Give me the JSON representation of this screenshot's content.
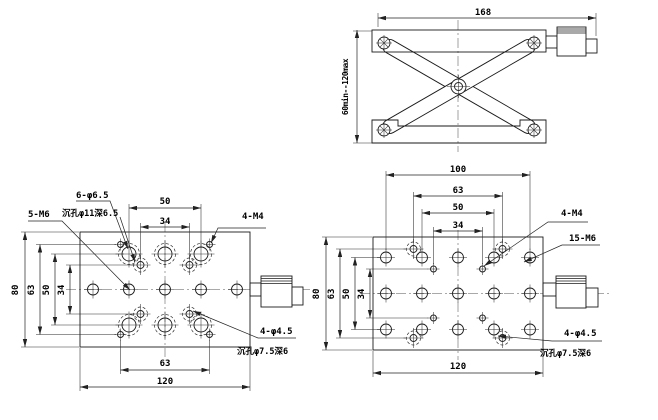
{
  "side_view": {
    "width": "168",
    "travel": "60min--120max"
  },
  "left_view": {
    "dim_top_50": "50",
    "dim_top_34": "34",
    "dim_left_80": "80",
    "dim_left_63": "63",
    "dim_left_50": "50",
    "dim_left_34": "34",
    "dim_bottom_63": "63",
    "dim_bottom_120": "120",
    "label_counterbore_qty": "6-φ6.5",
    "label_counterbore_spec": "沉孔φ11深6.5",
    "label_m6": "5-M6",
    "label_m4": "4-M4",
    "label_csk_qty": "4-φ4.5",
    "label_csk_spec": "沉孔φ7.5深6"
  },
  "right_view": {
    "dim_top_100": "100",
    "dim_top_63": "63",
    "dim_top_50": "50",
    "dim_top_34": "34",
    "dim_left_80": "80",
    "dim_left_63": "63",
    "dim_left_50": "50",
    "dim_left_34": "34",
    "dim_bottom_120": "120",
    "label_m4": "4-M4",
    "label_m6": "15-M6",
    "label_csk_qty": "4-φ4.5",
    "label_csk_spec": "沉孔φ7.5深6"
  },
  "colors": {
    "line": "#1a1a1a",
    "dimension": "#222222",
    "centerline": "#555555",
    "background": "#ffffff"
  }
}
